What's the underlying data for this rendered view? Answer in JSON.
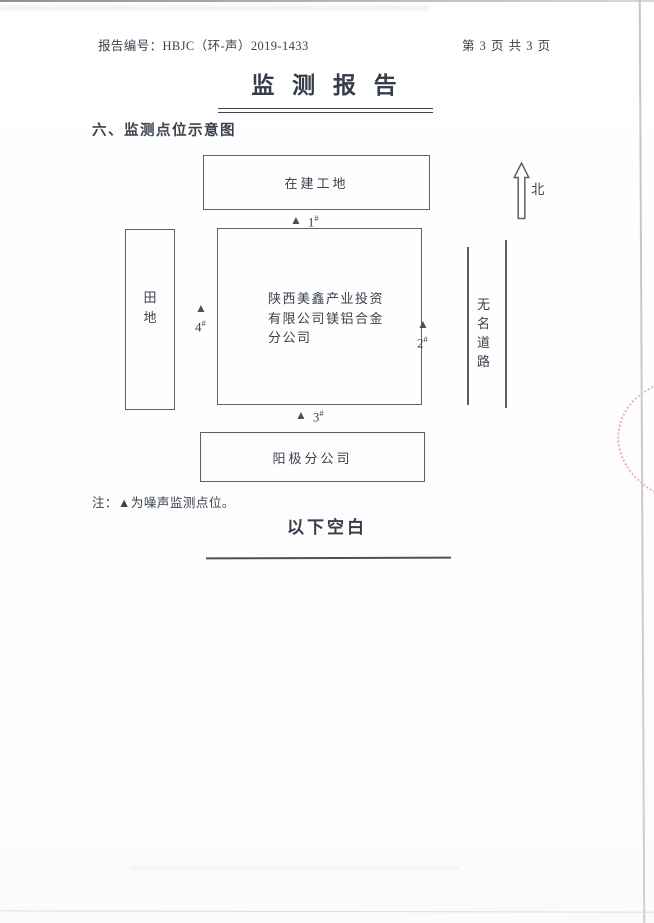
{
  "header": {
    "report_number": "报告编号：HBJC（环-声）2019-1433",
    "page_info": "第 3 页 共 3 页"
  },
  "title": "监 测 报 告",
  "section_heading": "六、监测点位示意图",
  "diagram": {
    "top_box_label": "在建工地",
    "north_label": "北",
    "field_label": "田地",
    "company_lines": [
      "陕西美鑫产业投资",
      "有限公司镁铝合金",
      "分公司"
    ],
    "road_label": "无名道路",
    "bottom_box_label": "阳极分公司",
    "points": [
      {
        "marker": "▲",
        "num": "1",
        "hash": "#"
      },
      {
        "marker": "▲",
        "num": "2",
        "hash": "#"
      },
      {
        "marker": "▲",
        "num": "3",
        "hash": "#"
      },
      {
        "marker": "▲",
        "num": "4",
        "hash": "#"
      }
    ]
  },
  "note": "注：▲为噪声监测点位。",
  "footer_blank": "以下空白",
  "colors": {
    "ink": "#39424d",
    "box_line": "#59616b",
    "stamp_red": "#cd4b5f"
  }
}
